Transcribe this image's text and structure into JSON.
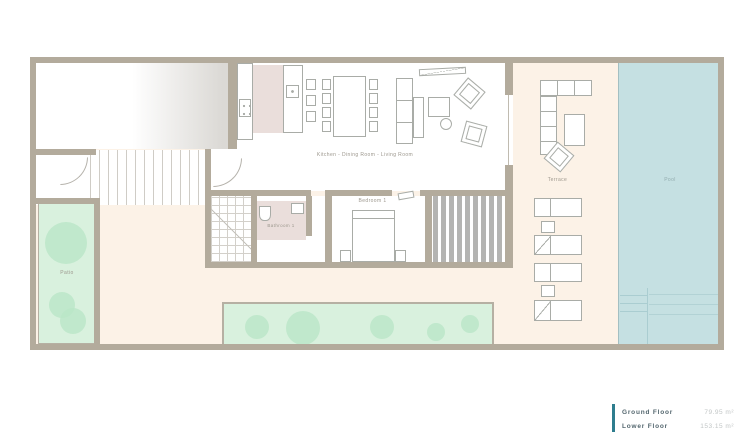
{
  "plan": {
    "labels": {
      "kitchen_living": "Kitchen - Dining Room - Living Room",
      "bedroom": "Bedroom 1",
      "bathroom": "Bathroom 1",
      "terrace": "Terrace",
      "pool": "Pool",
      "patio": "Patio"
    },
    "legend": {
      "rows": [
        {
          "label": "Ground Floor",
          "value": "79.95 m²"
        },
        {
          "label": "Lower Floor",
          "value": "153.15 m²"
        }
      ]
    },
    "colors": {
      "wall": "#b3ab9c",
      "terrace_floor": "#fcf2e7",
      "pool_water": "#c5e0e2",
      "garden": "#d9f1de",
      "bush": "#b9e6c7",
      "kitchen_accent": "#eadedb",
      "legend_accent": "#2e7d8e"
    }
  }
}
